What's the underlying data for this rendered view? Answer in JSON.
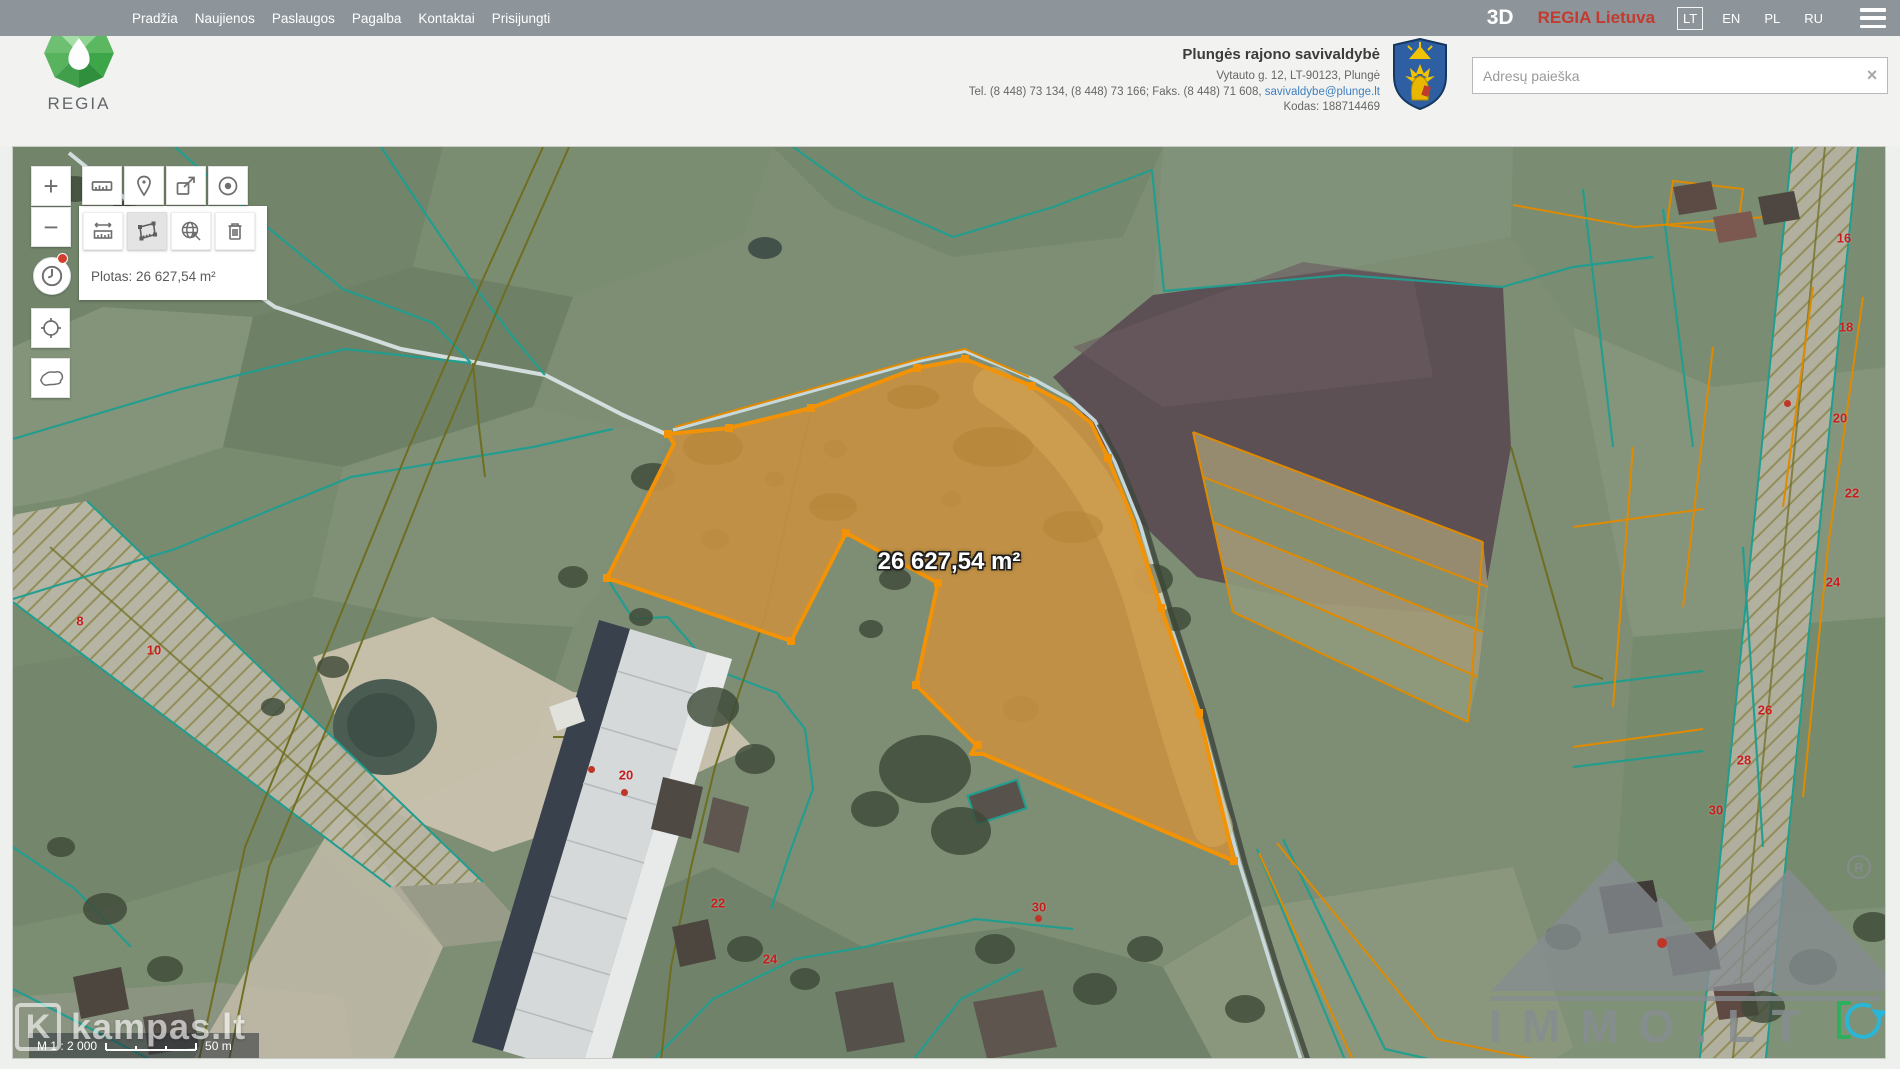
{
  "topbar": {
    "menu": [
      "Pradžia",
      "Naujienos",
      "Paslaugos",
      "Pagalba",
      "Kontaktai",
      "Prisijungti"
    ],
    "mode_3d": "3D",
    "brand": "REGIA Lietuva",
    "languages": {
      "active": "LT",
      "others": [
        "EN",
        "PL",
        "RU"
      ]
    }
  },
  "logo": {
    "text": "REGIA"
  },
  "header": {
    "municipality": "Plungės rajono savivaldybė",
    "address": "Vytauto g. 12, LT-90123, Plungė",
    "contacts": "Tel. (8 448) 73 134, (8 448) 73 166; Faks. (8 448) 71 608,",
    "email": "savivaldybe@plunge.lt",
    "code": "Kodas: 188714469"
  },
  "search": {
    "placeholder": "Adresų paieška",
    "clear_icon": "×"
  },
  "tools": {
    "zoom_in": "+",
    "zoom_out": "−",
    "area_result": "Plotas: 26 627,54 m²"
  },
  "map": {
    "area_label": "26 627,54 m²",
    "scale": {
      "ratio": "M 1 : 2 000",
      "distance": "50 m"
    },
    "watermarks": {
      "left": "kampas.lt",
      "right": "IMMO.LT",
      "registered": "®"
    },
    "parcel_numbers": [
      "8",
      "10",
      "16",
      "18",
      "20",
      "22",
      "24",
      "26",
      "28",
      "30",
      "20",
      "22",
      "24",
      "30"
    ]
  },
  "colors": {
    "parcel_stroke": "#f29207",
    "accent_red": "#c23b2e",
    "teal_line": "#1f9e90"
  }
}
